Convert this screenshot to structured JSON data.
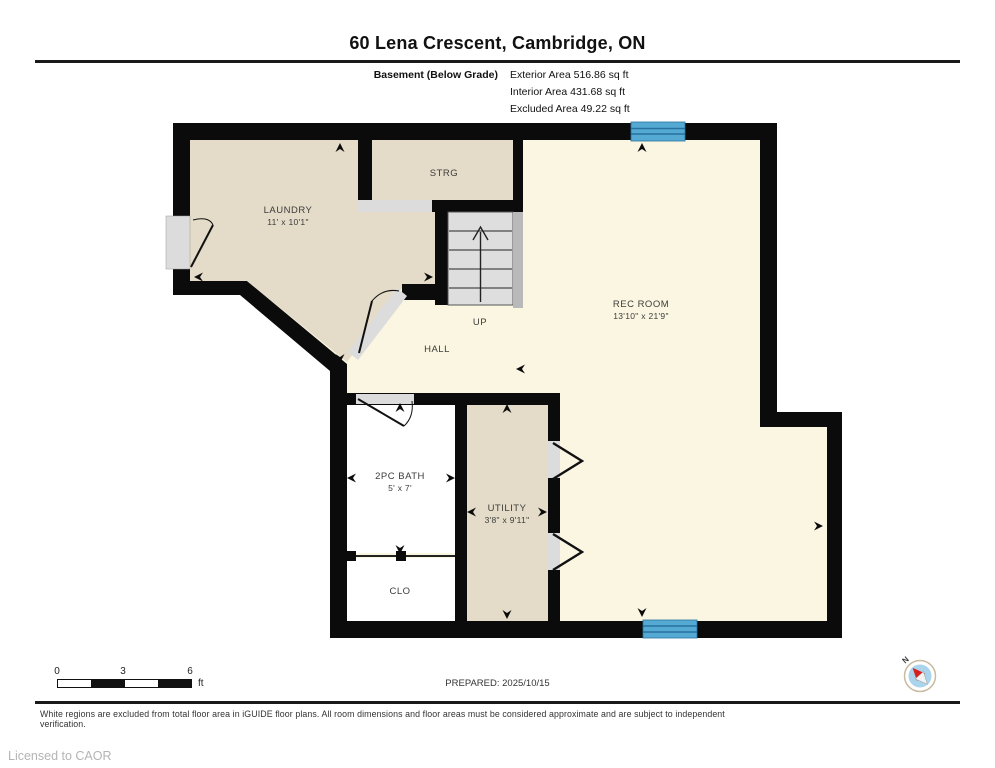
{
  "header": {
    "title": "60 Lena Crescent, Cambridge, ON",
    "floor_label": "Basement (Below Grade)",
    "area_lines": [
      "Exterior Area 516.86 sq ft",
      "Interior Area 431.68 sq ft",
      "Excluded Area 49.22 sq ft"
    ]
  },
  "rooms": {
    "laundry": {
      "name": "LAUNDRY",
      "dims": "11' x 10'1\""
    },
    "strg": {
      "name": "STRG"
    },
    "rec_room": {
      "name": "REC ROOM",
      "dims": "13'10\" x 21'9\""
    },
    "up": {
      "name": "UP"
    },
    "hall": {
      "name": "HALL"
    },
    "bath": {
      "name": "2PC BATH",
      "dims": "5' x 7'"
    },
    "utility": {
      "name": "UTILITY",
      "dims": "3'8\" x 9'11\""
    },
    "clo": {
      "name": "CLO"
    }
  },
  "scale_bar": {
    "ticks": [
      "0",
      "3",
      "6"
    ],
    "unit": "ft"
  },
  "footer": {
    "prepared": "PREPARED: 2025/10/15",
    "disclaimer": "White regions are excluded from total floor area in iGUIDE floor plans. All room dimensions and floor areas must be considered approximate and are subject to independent verification.",
    "licensed": "Licensed to CAOR"
  },
  "compass": {
    "north_label": "N"
  },
  "colors": {
    "wall": "#0b0b0b",
    "room_beige": "#e4dcc8",
    "room_cream": "#fbf6e2",
    "room_white": "#ffffff",
    "stairs_grey": "#dedede",
    "stair_strip_grey": "#b9b9b9",
    "door_grey": "#dcdcdc",
    "window_blue": "#55aad4",
    "window_line_blue": "#27719d"
  }
}
